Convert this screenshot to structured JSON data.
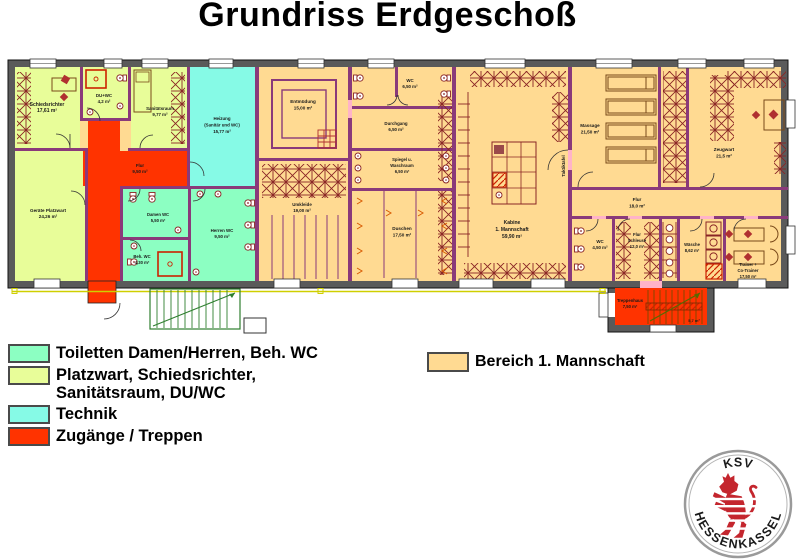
{
  "title": "Grundriss Erdgeschoß",
  "legend": {
    "items": [
      {
        "label": "Toiletten Damen/Herren, Beh. WC",
        "color": "#8cffc2"
      },
      {
        "label": "Platzwart, Schiedsrichter,",
        "label2": "Sanitätsraum, DU/WC",
        "color": "#e8fd99"
      },
      {
        "label": "Technik",
        "color": "#86fae6"
      },
      {
        "label": "Zugänge / Treppen",
        "color": "#ff3300"
      }
    ],
    "mannschaft": {
      "label": "Bereich 1. Mannschaft",
      "color": "#ffda92"
    }
  },
  "rooms": {
    "schiedsrichter": {
      "name": "Schiedsrichter",
      "area": "17,61 m²"
    },
    "du_wc": {
      "name": "DU+WC",
      "area": "4,2 m²"
    },
    "sanitaetsraum": {
      "name": "Sanitätsraum",
      "area": "9,77 m²"
    },
    "heizung": {
      "name": "Heizung",
      "sub": "(Sanitär und WC)",
      "area": "15,77 m²"
    },
    "flur_links": {
      "name": "Flur",
      "area": "9,50 m²"
    },
    "platzwart": {
      "name": "Geräte Platzwart",
      "area": "24,26 m²"
    },
    "damen_wc": {
      "name": "Damen WC",
      "area": "5,50 m²"
    },
    "beh_wc": {
      "name": "Beh. WC",
      "area": "4,30 m²"
    },
    "herren_wc": {
      "name": "Herren WC",
      "area": "9,50 m²"
    },
    "entmuedung": {
      "name": "Entmüdung",
      "area": "15,00 m²"
    },
    "umkleide": {
      "name": "Umkleide",
      "area": "19,00 m²"
    },
    "wc_mitte": {
      "name": "WC",
      "area": "6,50 m²"
    },
    "durchgang": {
      "name": "Durchgang",
      "area": "6,50 m²"
    },
    "spiegel": {
      "name": "Spiegel u.",
      "name2": "Waschraum",
      "area": "6,50 m²"
    },
    "duschen": {
      "name": "Duschen",
      "area": "17,50 m²"
    },
    "kabine": {
      "name": "Kabine",
      "sub": "1. Mannschaft",
      "area": "59,90 m²",
      "wand": "Taktiktafel"
    },
    "massage": {
      "name": "Massage",
      "area": "21,50 m²"
    },
    "zeugwart": {
      "name": "Zeugwart",
      "area": "21,5 m²"
    },
    "flur_rechts": {
      "name": "Flur",
      "area": "18,0 m²"
    },
    "wc_rechts": {
      "name": "WC",
      "area": "4,50 m²"
    },
    "schleuse": {
      "name": "Flur",
      "sub": "Schleuse",
      "area": "12,0 m²"
    },
    "waesche": {
      "name": "Wäsche",
      "area": "8,62 m²"
    },
    "trainer": {
      "name": "Trainer +",
      "sub": "Co-Trainer",
      "area": "17,50 m²"
    },
    "treppenhaus": {
      "name": "Treppenhaus",
      "area": "7,50 m²",
      "area2": "5,7 m²"
    }
  },
  "logo": {
    "top": "KSV",
    "left": "HESSEN",
    "right": "KASSEL"
  }
}
